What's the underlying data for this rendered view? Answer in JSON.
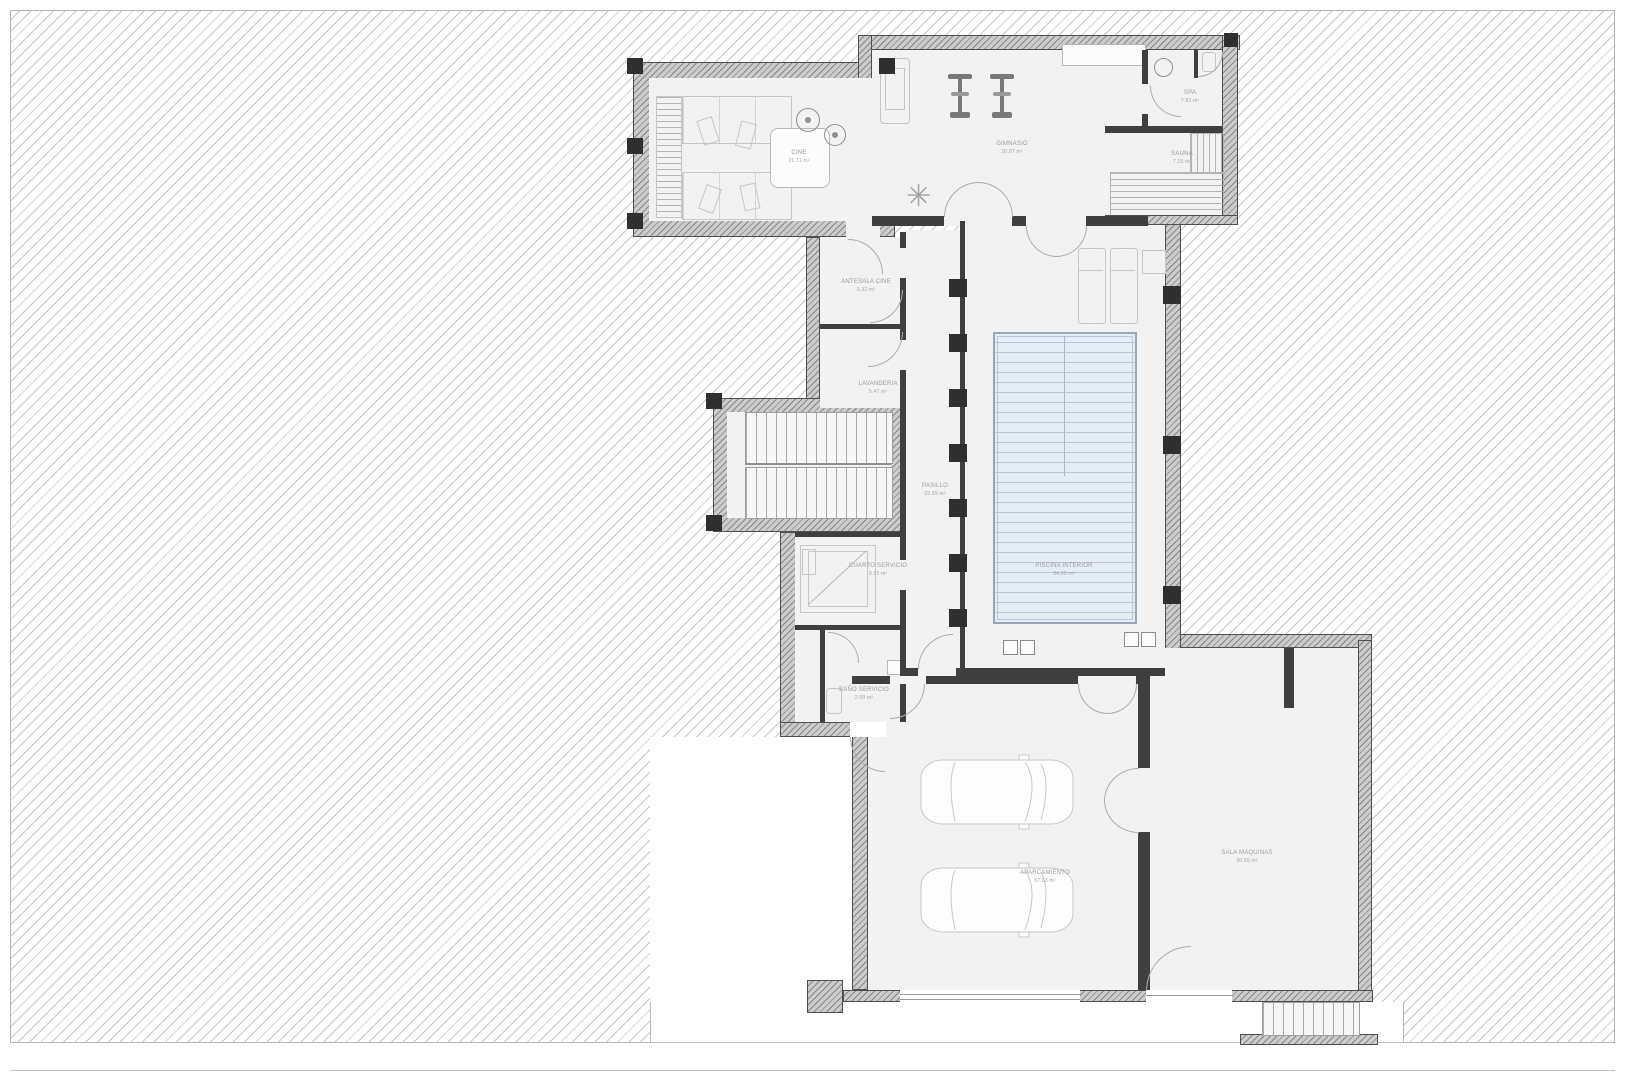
{
  "colors": {
    "hatch_line": "#c7c7c7",
    "exterior_wall": "#cccccc",
    "interior_wall": "#3f3f3f",
    "room_floor": "#f2f2f2",
    "pool_water": "#e4edf5",
    "label_text": "#9b9b9b"
  },
  "rooms": [
    {
      "id": "cine",
      "name": "CINE",
      "area": "21.71 m²"
    },
    {
      "id": "gimnasio",
      "name": "GIMNASIO",
      "area": "30.97 m²"
    },
    {
      "id": "spa",
      "name": "SPA",
      "area": "7.83 m²"
    },
    {
      "id": "sauna",
      "name": "SAUNA",
      "area": "7.15 m²"
    },
    {
      "id": "antesala-cine",
      "name": "ANTESALA CINE",
      "area": "6.32 m²"
    },
    {
      "id": "lavanderia",
      "name": "LAVANDERIA",
      "area": "5.47 m²"
    },
    {
      "id": "pasillo",
      "name": "PASILLO",
      "area": "23.85 m²"
    },
    {
      "id": "cuarto-servicio",
      "name": "CUARTO SERVICIO",
      "area": "9.15 m²"
    },
    {
      "id": "bano-servicio",
      "name": "BAÑO SERVICIO",
      "area": "2.09 m²"
    },
    {
      "id": "piscina-interior",
      "name": "PISCINA INTERIOR",
      "area": "64.95 m²"
    },
    {
      "id": "aparcamiento",
      "name": "APARCAMIENTO",
      "area": "57.03 m²"
    },
    {
      "id": "sala-maquinas",
      "name": "SALA MAQUINAS",
      "area": "30.65 m²"
    }
  ]
}
